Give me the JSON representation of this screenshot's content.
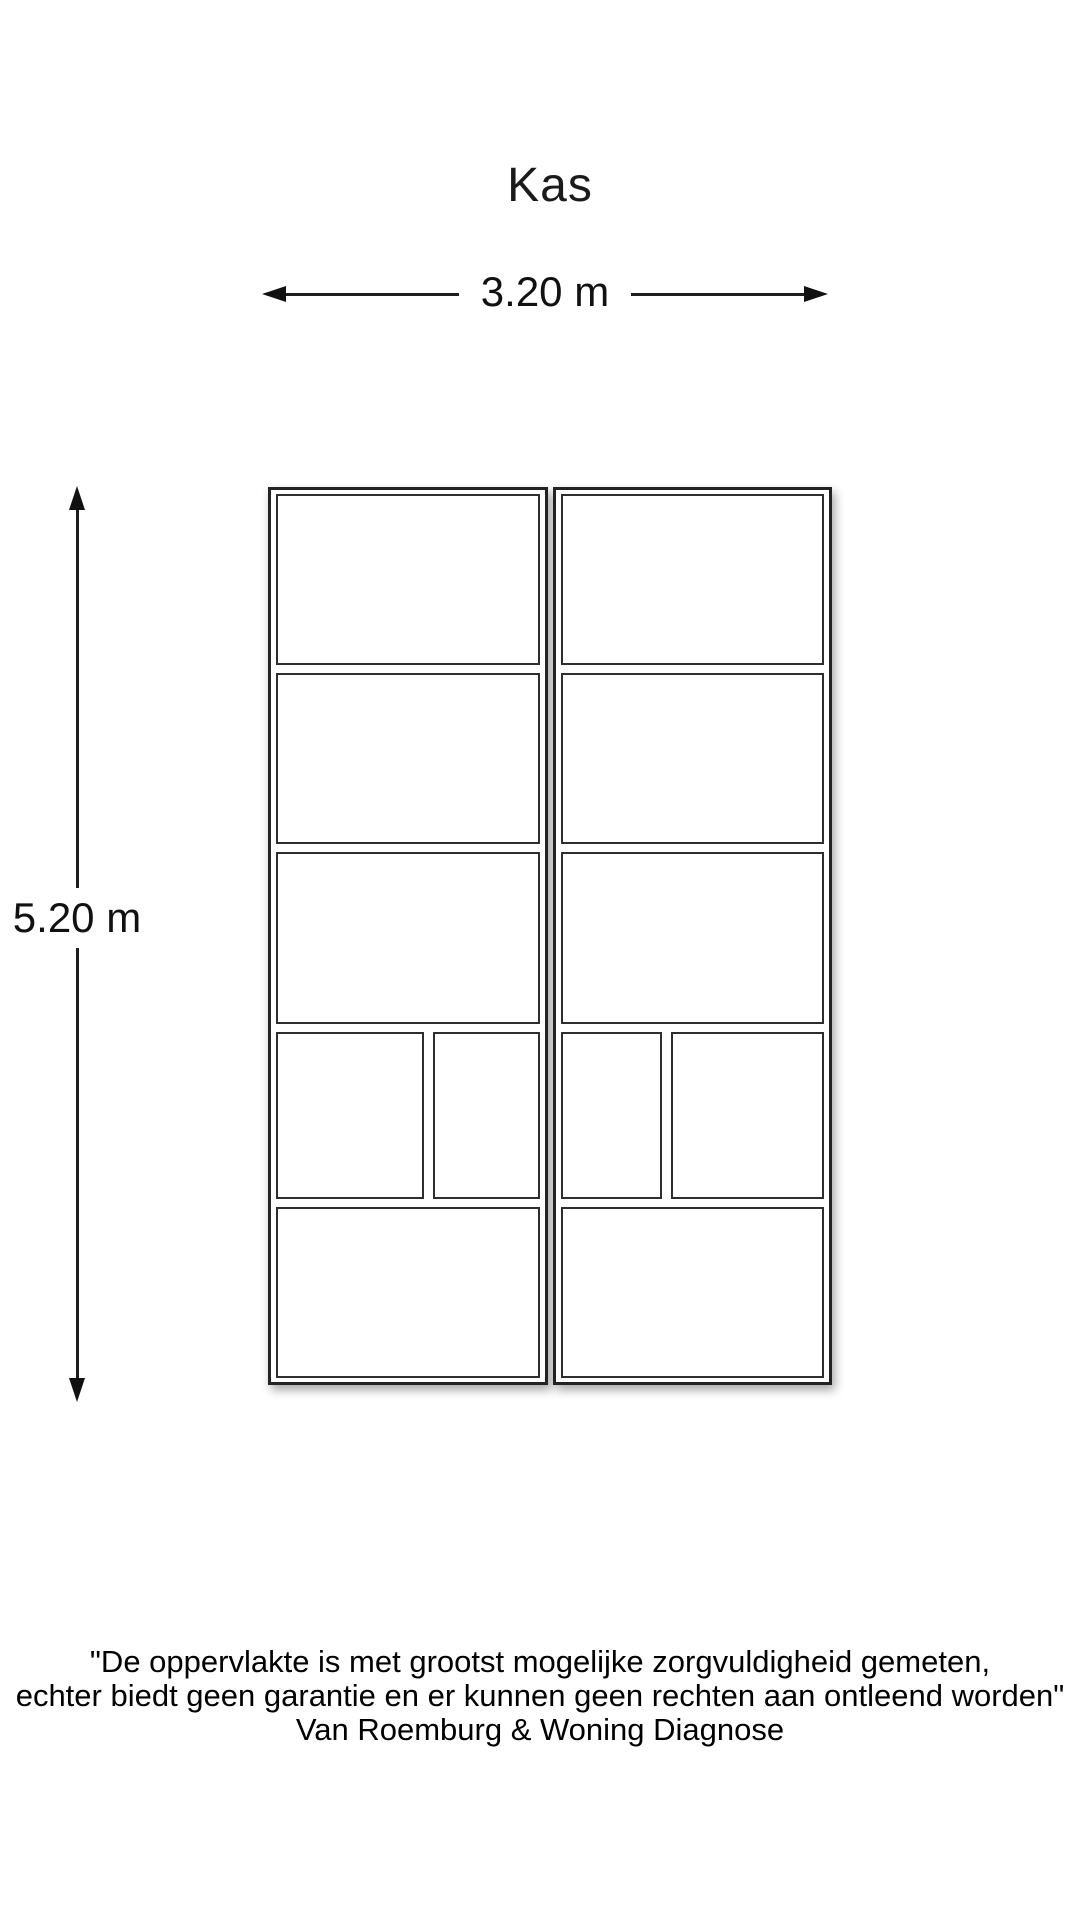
{
  "title": "Kas",
  "dimensions": {
    "width_label": "3.20 m",
    "height_label": "5.20 m"
  },
  "plan": {
    "panel_count": 2,
    "rows_per_panel": 5,
    "panels": [
      {
        "name": "left-greenhouse-panel",
        "rows": [
          {
            "split": false
          },
          {
            "split": false
          },
          {
            "split": false
          },
          {
            "split": true,
            "cells": [
              "58%",
              "42%"
            ]
          },
          {
            "split": false
          }
        ]
      },
      {
        "name": "right-greenhouse-panel",
        "rows": [
          {
            "split": false
          },
          {
            "split": false
          },
          {
            "split": false
          },
          {
            "split": true,
            "cells": [
              "40%",
              "60%"
            ]
          },
          {
            "split": false
          }
        ]
      }
    ]
  },
  "disclaimer": {
    "lines": [
      "\"De oppervlakte is met grootst mogelijke zorgvuldigheid gemeten,",
      "echter biedt geen garantie en er kunnen geen rechten aan ontleend worden\"",
      "Van Roemburg & Woning Diagnose"
    ]
  },
  "colors": {
    "wall": "#232323",
    "inner_line": "#2e2e2e",
    "dimension_line": "#1d1d1d",
    "text": "#111111",
    "background": "#ffffff"
  }
}
